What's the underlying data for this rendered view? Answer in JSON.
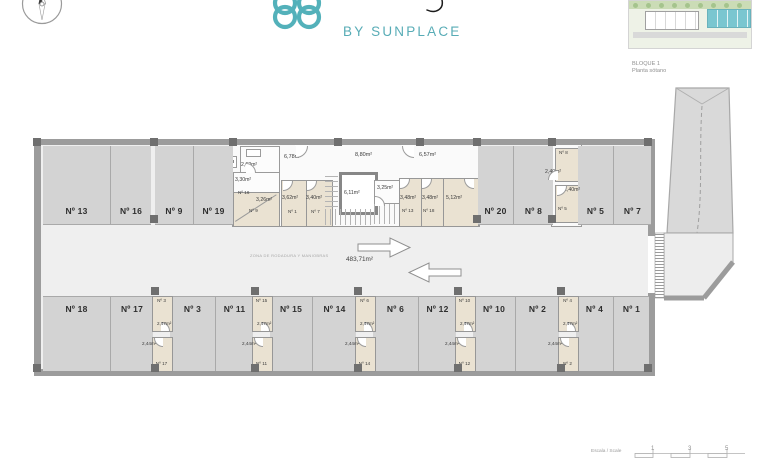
{
  "header": {
    "brand": "BY SUNPLACE",
    "accent": "#58ACB6"
  },
  "site": {
    "block": "BLOQUE 1",
    "floor": "Planta sótano"
  },
  "plan": {
    "aisle": {
      "note": "ZONA DE RODADURA Y MANIOBRAS",
      "area": "483,71m²"
    },
    "parking_top": [
      {
        "label": "Nº 13",
        "accessible": true
      },
      {
        "label": "Nº 16"
      },
      {
        "label": "Nº 9"
      },
      {
        "label": "Nº 19"
      },
      {
        "label": "Nº 20"
      },
      {
        "label": "Nº 8"
      },
      {
        "label": "Nº 5"
      },
      {
        "label": "Nº 7"
      }
    ],
    "parking_bottom": [
      {
        "label": "Nº 18",
        "accessible": true
      },
      {
        "label": "Nº 17"
      },
      {
        "label": "Nº 3"
      },
      {
        "label": "Nº 11"
      },
      {
        "label": "Nº 15"
      },
      {
        "label": "Nº 14"
      },
      {
        "label": "Nº 6"
      },
      {
        "label": "Nº 12"
      },
      {
        "label": "Nº 10"
      },
      {
        "label": "Nº 2"
      },
      {
        "label": "Nº 4"
      },
      {
        "label": "Nº 1"
      }
    ],
    "storage_columns": [
      {
        "top": {
          "label": "Nº 3",
          "area": "2,47m²"
        },
        "bottom": {
          "label": "Nº 17",
          "area": "2,44m²"
        }
      },
      {
        "top": {
          "label": "Nº 15",
          "area": "2,47m²"
        },
        "bottom": {
          "label": "Nº 11",
          "area": "2,44m²"
        }
      },
      {
        "top": {
          "label": "Nº 6",
          "area": "2,47m²"
        },
        "bottom": {
          "label": "Nº 14",
          "area": "2,44m²"
        }
      },
      {
        "top": {
          "label": "Nº 10",
          "area": "2,47m²"
        },
        "bottom": {
          "label": "Nº 12",
          "area": "2,44m²"
        }
      },
      {
        "top": {
          "label": "Nº 4",
          "area": "2,47m²"
        },
        "bottom": {
          "label": "Nº 2",
          "area": "2,44m²"
        }
      }
    ],
    "core": {
      "room_262": "2,62m²",
      "room_330": "3,30m²",
      "st_n16": "Nº 16",
      "room_326": "3,26m²",
      "st_n9": "Nº 9",
      "corr_678": "6,78m²",
      "st_362": "3,62m²",
      "st_n1": "Nº 1",
      "st_340": "3,40m²",
      "st_n7": "Nº 7",
      "lift_611": "6,11m²",
      "corr_880": "8,80m²",
      "room_325": "3,25m²",
      "corr_657": "6,57m²",
      "st_348a": "3,48m²",
      "st_n13": "Nº 13",
      "st_348b": "3,48m²",
      "st_n18": "Nº 18",
      "st_512": "5,12m²",
      "st_n8": "Nº 8",
      "st_240a": "2,40m²",
      "st_240b": "2,40m²",
      "st_n5": "Nº 5"
    }
  },
  "scale": {
    "label": "Escala / Scale",
    "ticks": [
      "1",
      "3",
      "5"
    ]
  },
  "colors": {
    "accent": "#58ACB6",
    "wall": "#9C9C9C",
    "stall": "#D3D3D3",
    "storage": "#EAE2D2",
    "aisle": "#EFEFEF",
    "site_highlight": "#7AC6D0"
  }
}
